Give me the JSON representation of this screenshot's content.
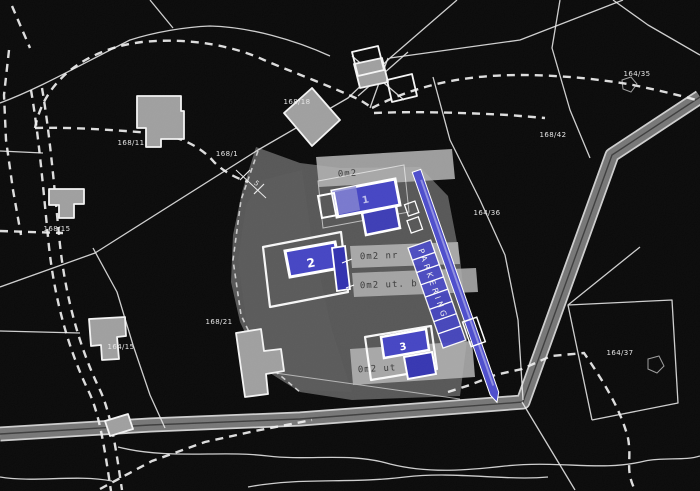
{
  "map": {
    "parcel_labels": [
      {
        "text": "168/11"
      },
      {
        "text": "168/1"
      },
      {
        "text": "168/18"
      },
      {
        "text": "164/35"
      },
      {
        "text": "168/42"
      },
      {
        "text": "164/36"
      },
      {
        "text": "168/15"
      },
      {
        "text": "168/21"
      },
      {
        "text": "164/15"
      },
      {
        "text": "164/37"
      }
    ],
    "proposed_buildings": [
      {
        "number": "1"
      },
      {
        "number": "2"
      },
      {
        "number": "3"
      }
    ],
    "parking_label": "PARKERING",
    "dimension_marker": "5",
    "annotations": [
      {
        "text": "0m2"
      },
      {
        "text": "0m2  nr"
      },
      {
        "text": "0m2 ut. b"
      },
      {
        "text": "0m2 ut"
      }
    ],
    "colors": {
      "background": "#070707",
      "boundary_line": "#e9e9e9",
      "road_fill": "#757575",
      "existing_building": "#9e9e9e",
      "proposed_building": "#4343c2",
      "proposed_building_dark": "#2f2fae",
      "parking_strip": "#4b4bcb",
      "overlay_gray": "#747474",
      "text_patch": "#b5b5b5"
    }
  }
}
